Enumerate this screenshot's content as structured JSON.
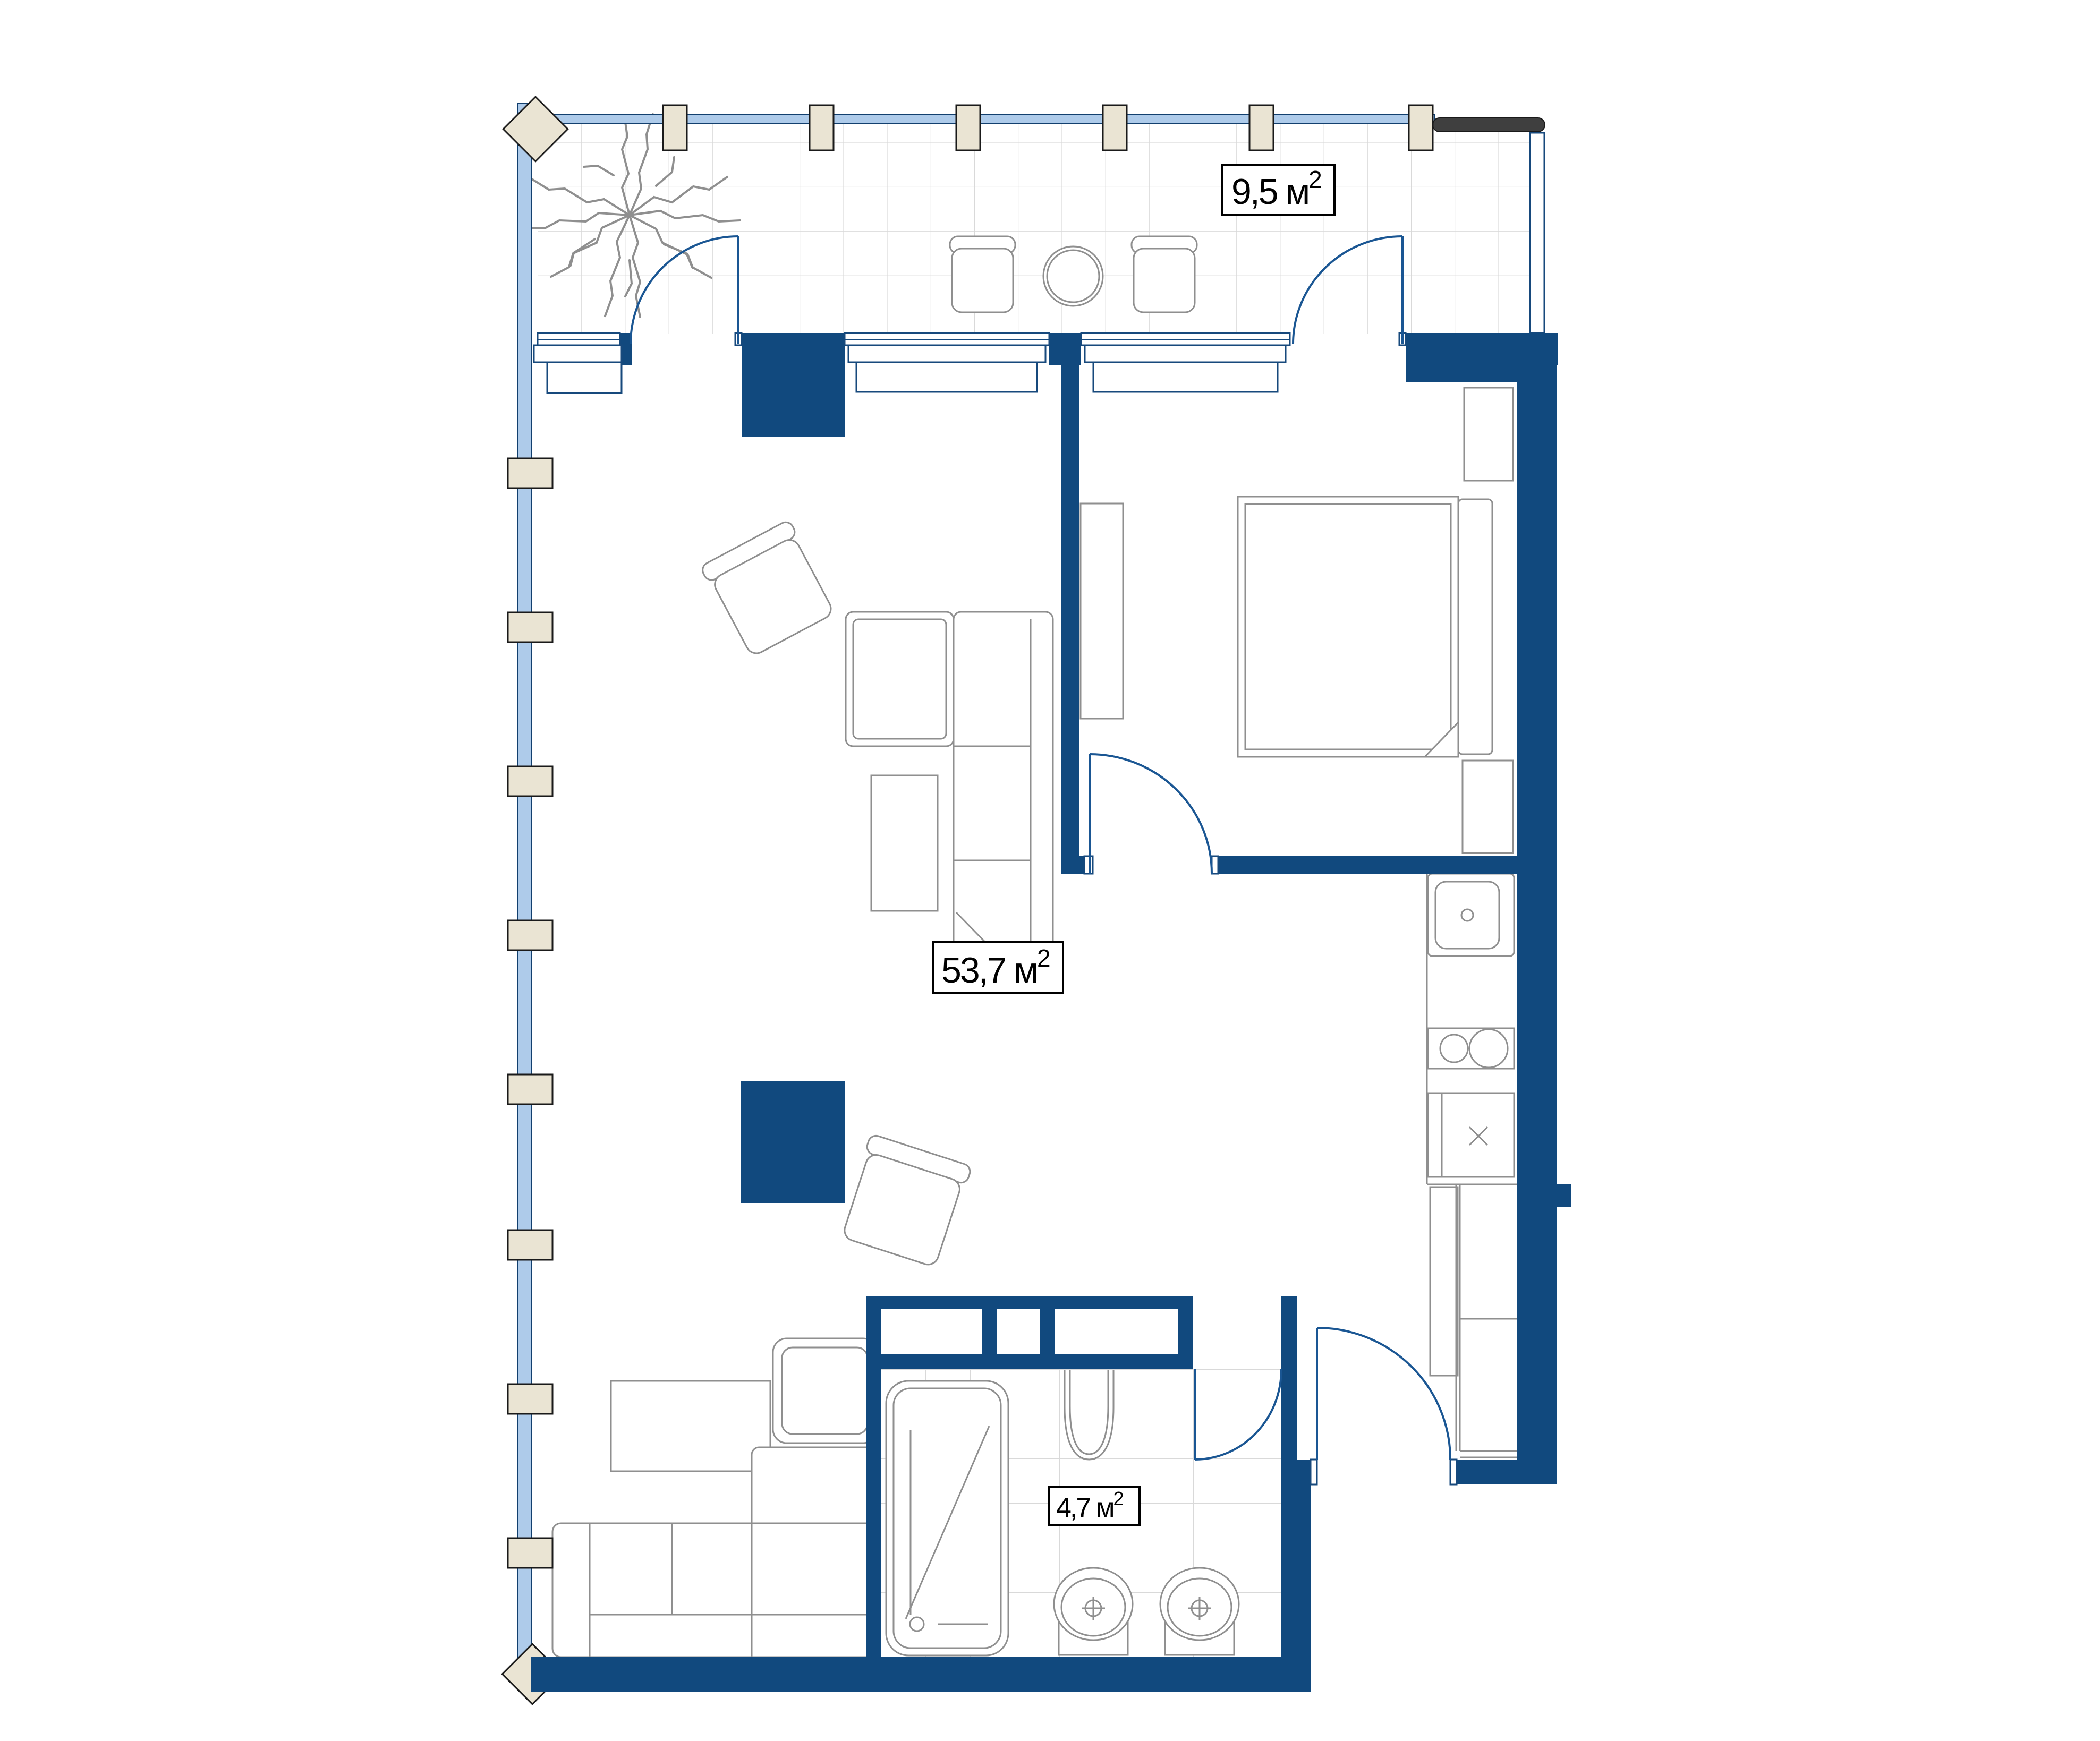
{
  "plan": {
    "type": "apartment-floor-plan",
    "labels": {
      "balcony": {
        "text": "9,5 м",
        "sup": "2"
      },
      "living": {
        "text": "53,7 м",
        "sup": "2"
      },
      "bathroom": {
        "text": "4,7 м",
        "sup": "2"
      }
    },
    "colors": {
      "wall": "#11497E",
      "door_arc": "#1A5693",
      "glazing": "#AECBEA",
      "window_frame": "#17497C",
      "mullion": "#EAE4D3",
      "tile_line": "#D9D9D9",
      "furniture_line": "#8F8F8F",
      "railing": "#3F3F3F",
      "label_border": "#000000",
      "background": "#FFFFFF"
    }
  }
}
